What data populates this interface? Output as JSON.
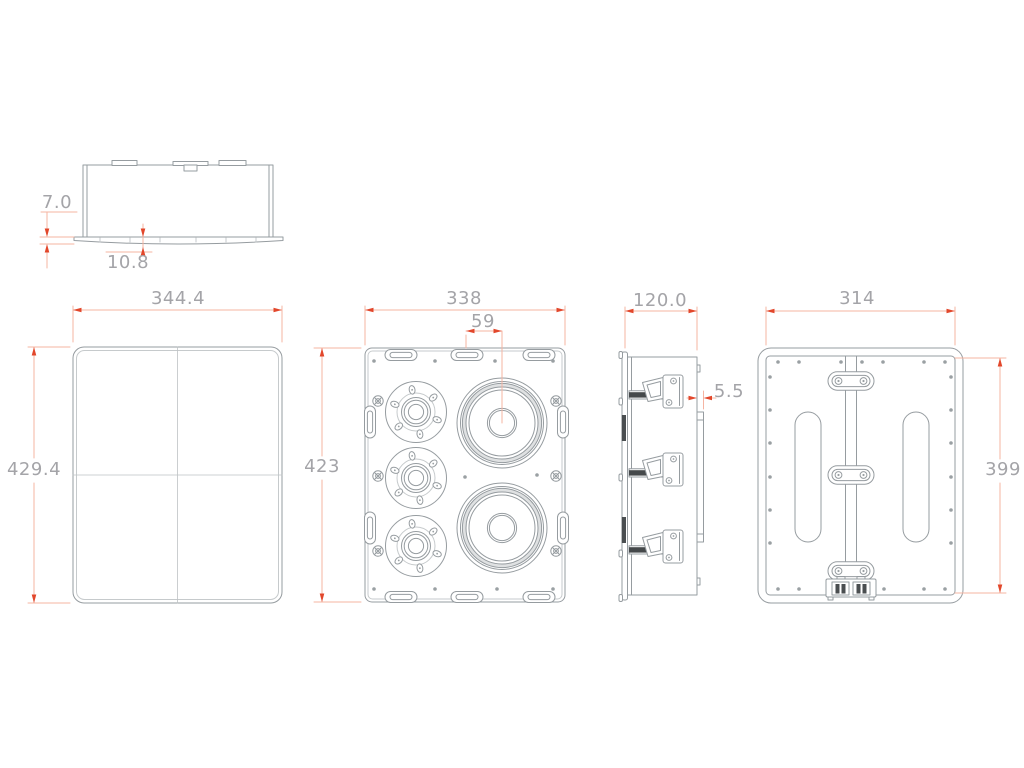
{
  "dims": {
    "top_profile": {
      "flange_thickness": "7.0",
      "flange_depth": "10.8"
    },
    "overall": {
      "width": "344.4",
      "height": "429.4"
    },
    "baffle": {
      "width": "338",
      "offset": "59",
      "height": "423"
    },
    "side": {
      "depth": "120.0",
      "gap": "5.5"
    },
    "rear": {
      "width": "314",
      "height": "399"
    }
  },
  "colors": {
    "line": "#969ca0",
    "dim_line": "#f5b4a2",
    "arrow": "#e2472b",
    "label_text": "#a4a4a8",
    "background": "#ffffff"
  }
}
